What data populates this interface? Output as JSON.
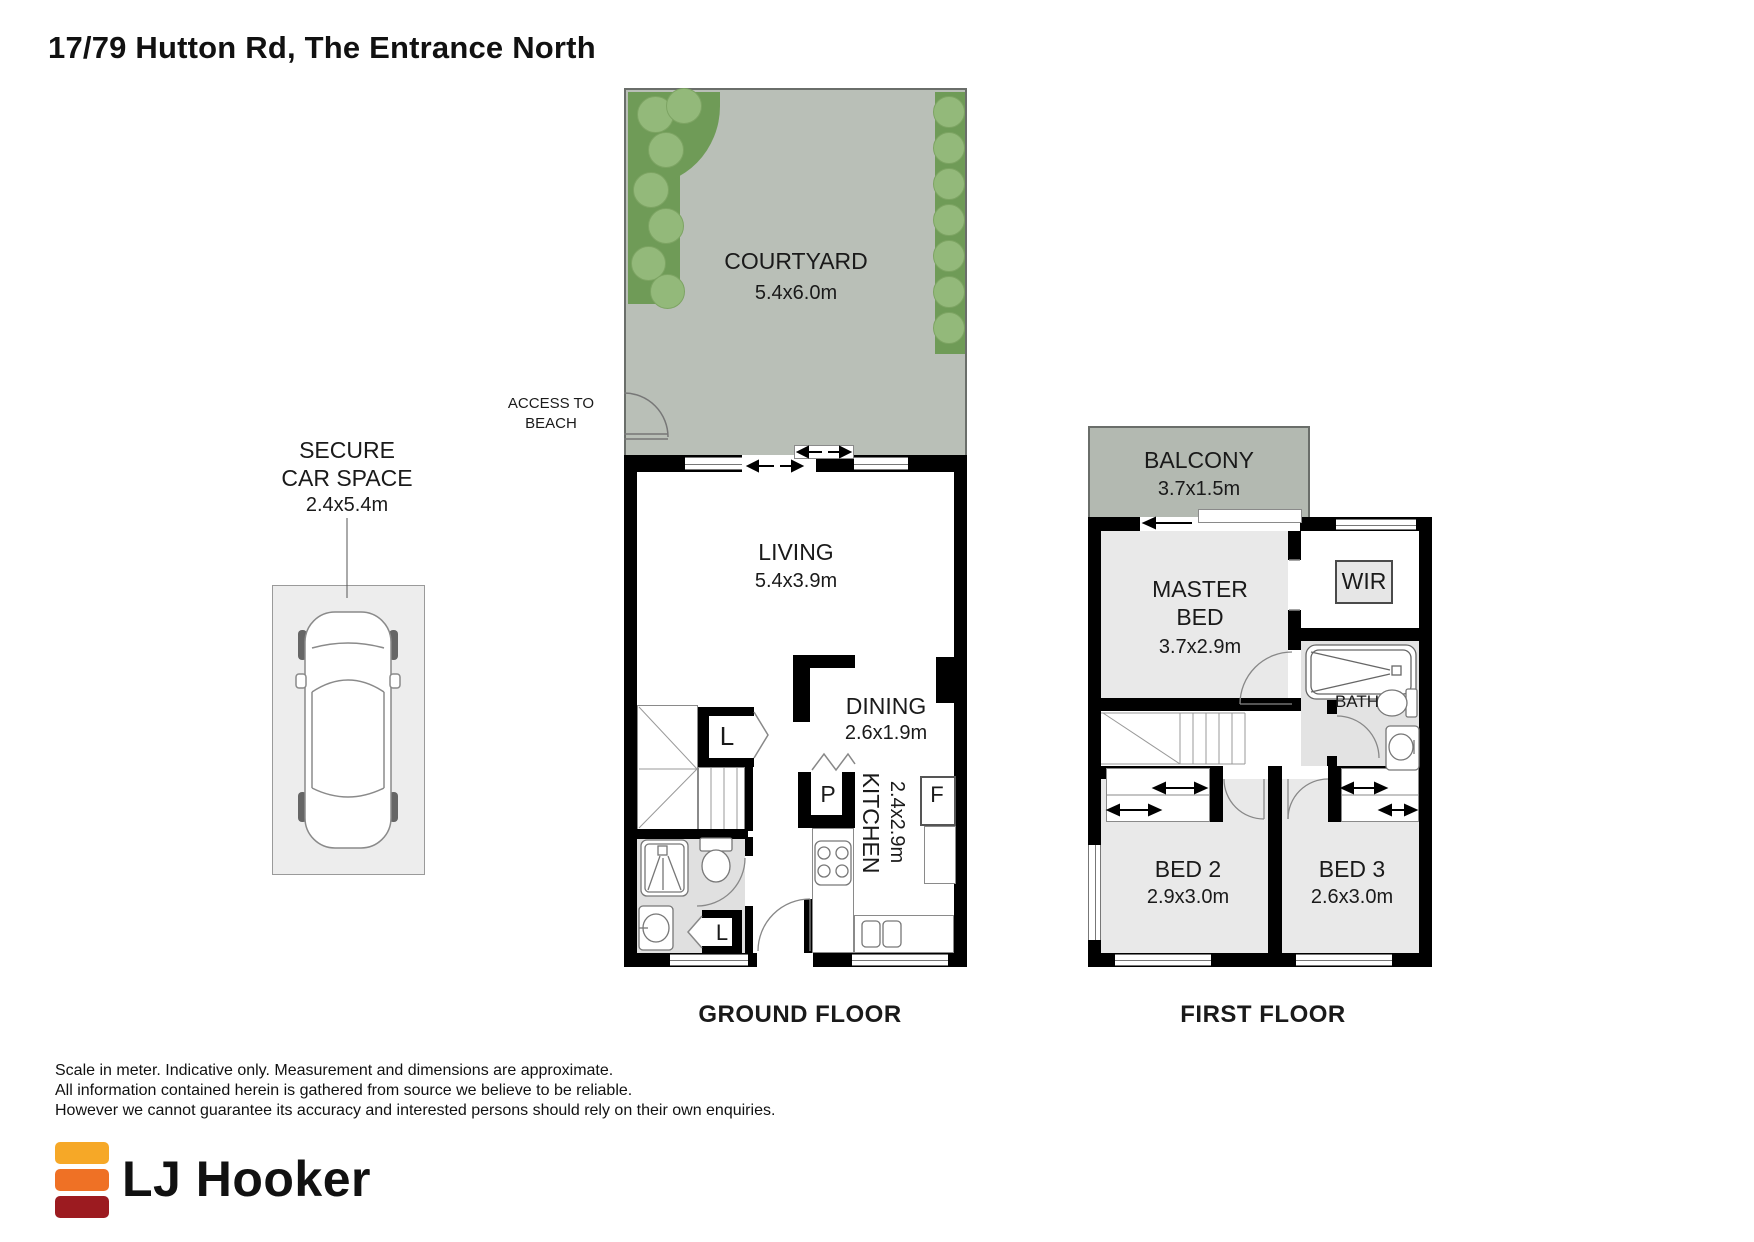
{
  "title": "17/79 Hutton Rd, The Entrance North",
  "ground_floor": {
    "caption": "GROUND FLOOR",
    "access": {
      "line1": "ACCESS TO",
      "line2": "BEACH"
    },
    "rooms": {
      "courtyard": {
        "name": "COURTYARD",
        "dims": "5.4x6.0m"
      },
      "living": {
        "name": "LIVING",
        "dims": "5.4x3.9m"
      },
      "dining": {
        "name": "DINING",
        "dims": "2.6x1.9m"
      },
      "kitchen": {
        "name": "KITCHEN",
        "dims": "2.4x2.9m"
      }
    },
    "markers": {
      "laundry": "L",
      "pantry": "P",
      "fridge": "F",
      "linen": "L"
    }
  },
  "car_space": {
    "line1": "SECURE",
    "line2": "CAR SPACE",
    "dims": "2.4x5.4m"
  },
  "first_floor": {
    "caption": "FIRST FLOOR",
    "rooms": {
      "balcony": {
        "name": "BALCONY",
        "dims": "3.7x1.5m"
      },
      "master": {
        "line1": "MASTER",
        "line2": "BED",
        "dims": "3.7x2.9m"
      },
      "wir": {
        "name": "WIR"
      },
      "bath": {
        "name": "BATH"
      },
      "bed2": {
        "name": "BED 2",
        "dims": "2.9x3.0m"
      },
      "bed3": {
        "name": "BED 3",
        "dims": "2.6x3.0m"
      }
    }
  },
  "footer": {
    "line1": "Scale in meter. Indicative only. Measurement and dimensions are approximate.",
    "line2": "All information contained herein is gathered from source we believe to be reliable.",
    "line3": "However we cannot guarantee its accuracy and interested persons should rely on their own enquiries.",
    "brand": "LJ Hooker"
  },
  "colors": {
    "courtyard_grey": "#b9bfb7",
    "balcony_grey": "#b3b9b1",
    "garden_green": "#6f9b57",
    "bush_green": "#93b97a",
    "room_grey": "#e9e9e9",
    "logo_yellow": "#F6A827",
    "logo_orange": "#EF7125",
    "logo_red": "#9C1B20"
  }
}
